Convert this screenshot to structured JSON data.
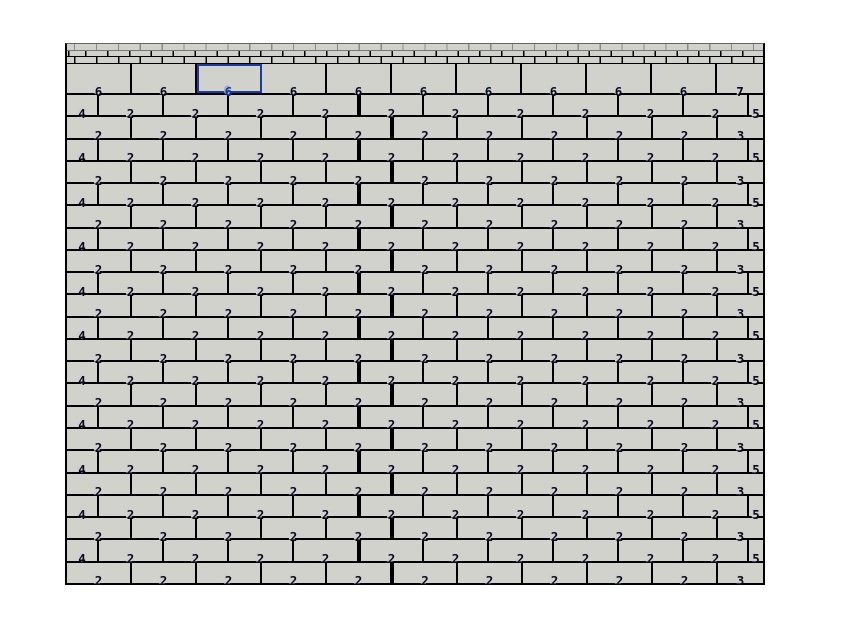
{
  "app": {
    "background_color": "#ffffff",
    "description": "brick-coursing grid canvas with selected cell"
  },
  "wall": {
    "x": 65,
    "y": 43,
    "width": 700,
    "height": 542,
    "fill_color": "#d2d2cd",
    "line_color": "#000000",
    "selection_color": "#1e3c9e",
    "digit_color": "#0b0b16",
    "digit_ghost_color": "#c9cdd8",
    "header_band": {
      "height": 20,
      "brick_width": 21.9,
      "courses": [
        {
          "offset": 7,
          "light": true
        },
        {
          "offset": 18,
          "light": false
        },
        {
          "offset": 7,
          "light": false
        }
      ]
    },
    "selection": {
      "row_index": 0,
      "cell_index": 2,
      "value": "6"
    },
    "row_types": {
      "six": {
        "widths": [
          65,
          65,
          65,
          65,
          65,
          65,
          65,
          65,
          65,
          65,
          46
        ],
        "labels": [
          "6",
          "6",
          "6",
          "6",
          "6",
          "6",
          "6",
          "6",
          "6",
          "6",
          "7"
        ],
        "divider_after": -1
      },
      "four": {
        "widths": [
          32,
          65,
          65,
          65,
          65,
          63,
          65,
          65,
          65,
          65,
          65,
          14
        ],
        "labels": [
          "4",
          "2",
          "2",
          "2",
          "2",
          "2",
          "2",
          "2",
          "2",
          "2",
          "2",
          "5"
        ],
        "divider_after": 4
      },
      "two": {
        "widths": [
          65,
          65,
          65,
          65,
          65,
          64,
          65,
          65,
          65,
          65,
          44
        ],
        "labels": [
          "2",
          "2",
          "2",
          "2",
          "2",
          "2",
          "2",
          "2",
          "2",
          "2",
          "3"
        ],
        "divider_after": 4
      }
    },
    "row_sequence": [
      "six",
      "four",
      "two",
      "four",
      "two",
      "four",
      "two",
      "four",
      "two",
      "four",
      "two",
      "four",
      "two",
      "four",
      "two",
      "four",
      "two",
      "four",
      "two",
      "four",
      "two",
      "four",
      "two"
    ]
  }
}
